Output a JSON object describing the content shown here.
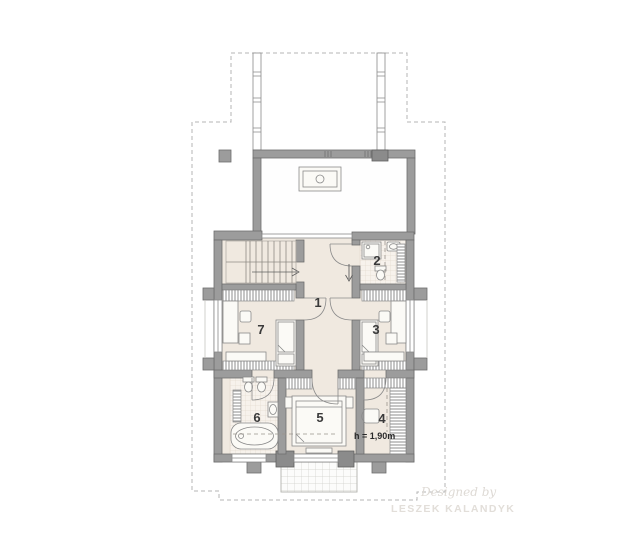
{
  "floor_plan": {
    "rooms": {
      "r1": "1",
      "r2": "2",
      "r3": "3",
      "r4": "4",
      "r5": "5",
      "r6": "6",
      "r7": "7"
    },
    "annotations": {
      "height_note": "h = 1,90m"
    },
    "watermark": {
      "prefix": "Designed by",
      "name": "LESZEK KALANDYK"
    },
    "icons": {
      "stairs-icon": "U-shaped stair flights with direction arrow",
      "chimney-icon": "double rectangle with circle",
      "bathtub-icon": "rounded rectangle with inner oval and drain",
      "toilet-icon": "tank with oval bowl",
      "bidet-icon": "tank with oval bowl",
      "sink-icon": "rectangle with oval basin",
      "shower-icon": "square tray with drain dot",
      "bed-icon": "rectangle with mattress, pillow and fold line",
      "desk-icon": "rectangle with chair square",
      "door-arc-icon": "quarter-circle swing arc",
      "direction-arrow-icon": "down arrow at bathroom entrance",
      "wardrobe-icon": "hatched built-in closet strip",
      "balcony-icon": "tiled grid terrace"
    },
    "colors": {
      "background": "#ffffff",
      "wall": "#9c9c9c",
      "wall_border": "#6e6e6e",
      "dark_pillar": "#8b8b8b",
      "floor_beige": "#f0e9e0",
      "tile_floor": "#f7f2ec",
      "tile_grid": "#e5dcd0",
      "furniture": "#fbfaf6",
      "outline": "#8a8a8a",
      "roof_dashed": "#b5b5b5",
      "label_text": "#3a3a3a",
      "watermark": "#dedad5"
    }
  }
}
